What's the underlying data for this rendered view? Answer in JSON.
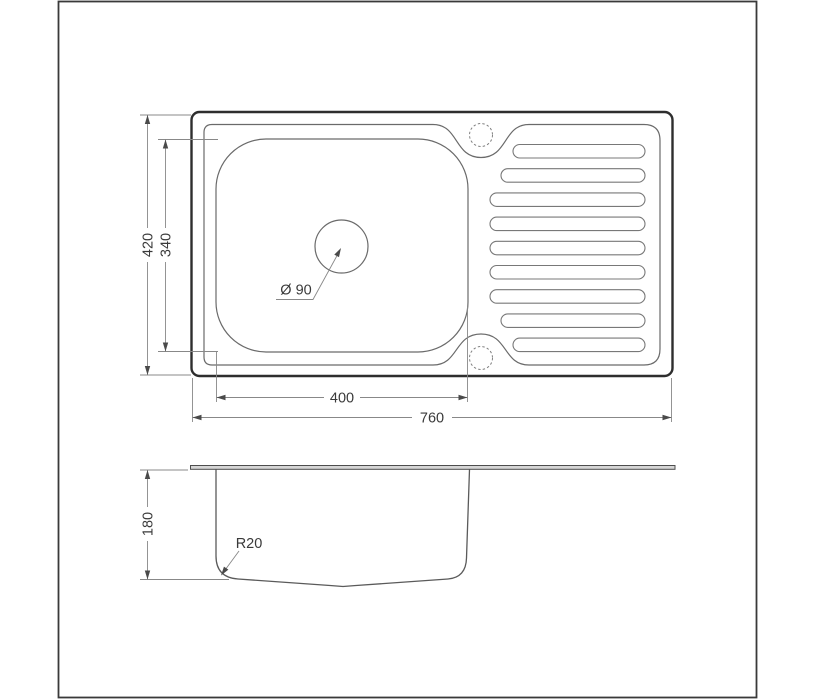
{
  "drawing": {
    "kind": "kitchen-sink-technical-drawing",
    "colors": {
      "background": "#ffffff",
      "outline": "#2e2e2e",
      "thin_line": "#6a6a6a",
      "dimension_line": "#888888",
      "text": "#3a3a3a",
      "section_fill": "#d6d6d6"
    },
    "top_view": {
      "dimensions": {
        "overall_height": "420",
        "bowl_height": "340",
        "bowl_width": "400",
        "overall_width": "760",
        "drain_diameter": "Ø 90"
      }
    },
    "section_view": {
      "dimensions": {
        "bowl_depth": "180",
        "bottom_radius": "R20"
      }
    }
  }
}
